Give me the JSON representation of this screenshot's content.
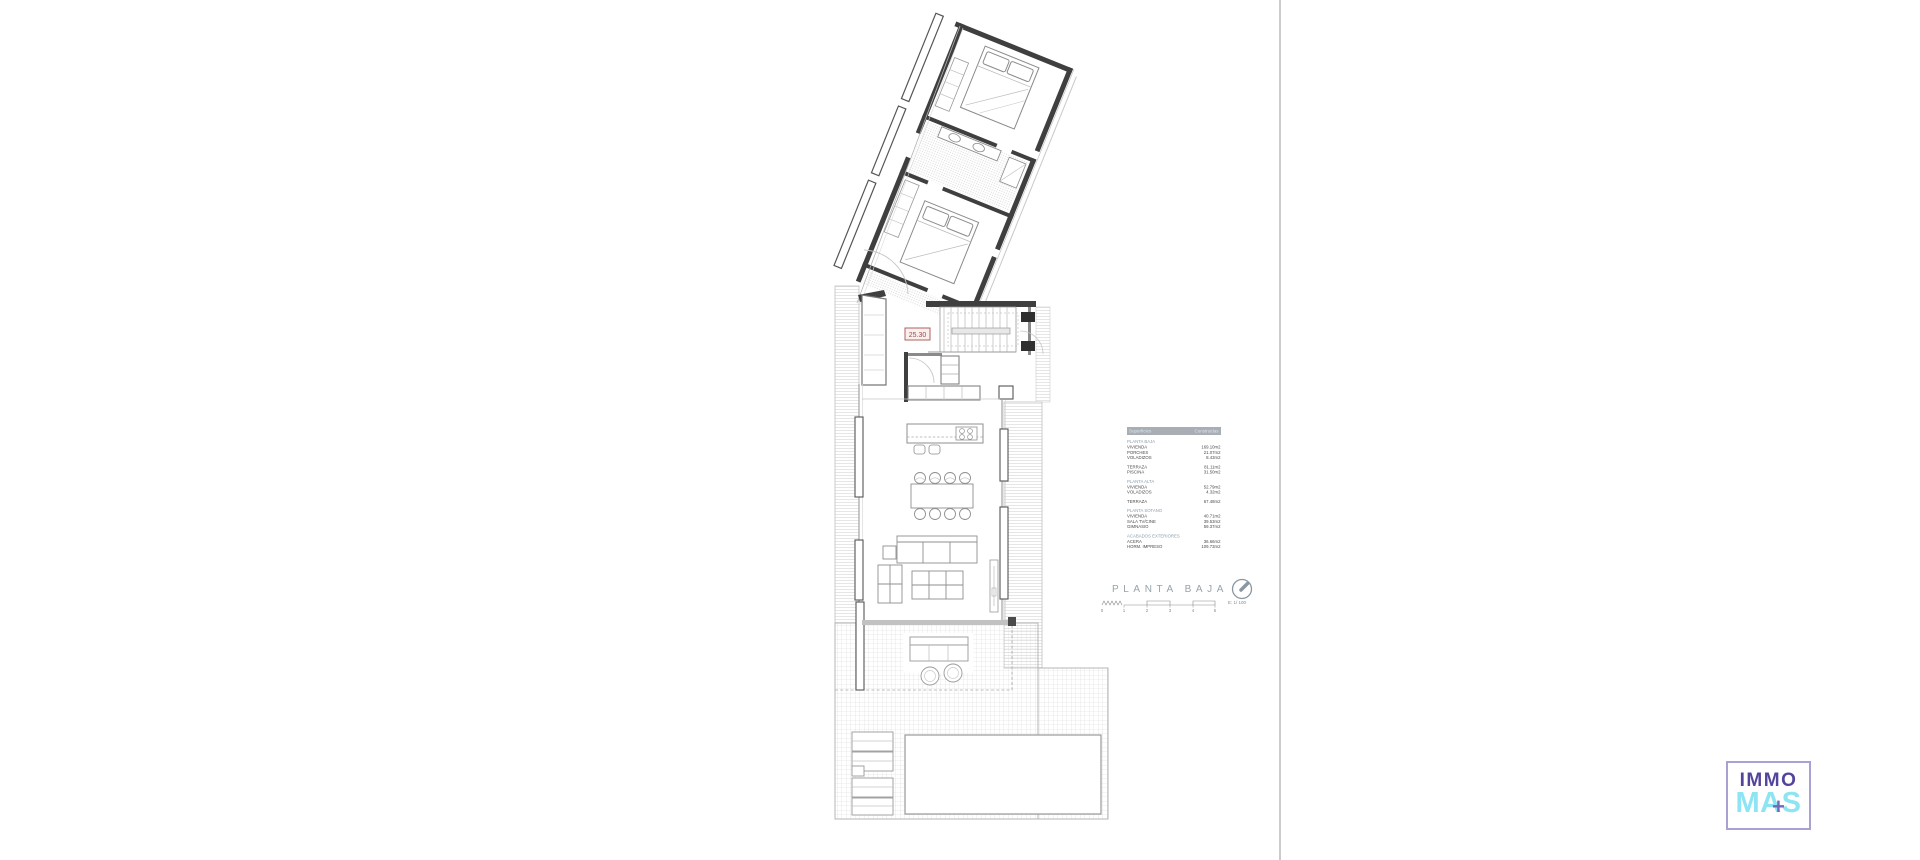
{
  "plan": {
    "dimension_label": "25.30",
    "title": "PLANTA BAJA",
    "scale_label": "E: 1/ 100",
    "scale_ticks": [
      "0",
      "1",
      "2",
      "3",
      "4",
      "5"
    ]
  },
  "surfaces": {
    "header": {
      "col1": "Superficies",
      "col2": "Construidas"
    },
    "groups": [
      {
        "title": "PLANTA BAJA",
        "rows": [
          {
            "label": "VIVIENDA",
            "value": "169.10m2"
          },
          {
            "label": "PORCHES",
            "value": "21.07m2"
          },
          {
            "label": "VOLADIZOS",
            "value": "8.43m2"
          }
        ]
      },
      {
        "title": "",
        "rows": [
          {
            "label": "TERRAZA",
            "value": "81.11m2"
          },
          {
            "label": "PISCINA",
            "value": "31.50m2"
          }
        ]
      },
      {
        "title": "PLANTA ALTA",
        "rows": [
          {
            "label": "VIVIENDA",
            "value": "52.79m2"
          },
          {
            "label": "VOLADIZOS",
            "value": "4.32m2"
          }
        ]
      },
      {
        "title": "",
        "rows": [
          {
            "label": "TERRAZA",
            "value": "67.48m2"
          }
        ]
      },
      {
        "title": "PLANTA SOTANO",
        "rows": [
          {
            "label": "VIVIENDA",
            "value": "40.71m2"
          },
          {
            "label": "SALA TV/CINE",
            "value": "39.53m2"
          },
          {
            "label": "GIMNASIO",
            "value": "59.37m2"
          }
        ]
      },
      {
        "title": "ACABADOS EXTERIORES",
        "rows": [
          {
            "label": "ACERA",
            "value": "36.66m2"
          },
          {
            "label": "HORM. IMPRESO",
            "value": "109.73m2"
          }
        ]
      }
    ]
  },
  "logo": {
    "line1": "IMMO",
    "line2": "MAS",
    "plus": "+"
  },
  "colors": {
    "table_header_bg": "#a9aeb4",
    "table_header_text": "#dbe6ee",
    "section_title": "#8b9dab",
    "dimension_red": "#a04848",
    "logo_purple": "#55449c",
    "logo_cyan": "#8de5f4",
    "separator": "#cccccc"
  }
}
